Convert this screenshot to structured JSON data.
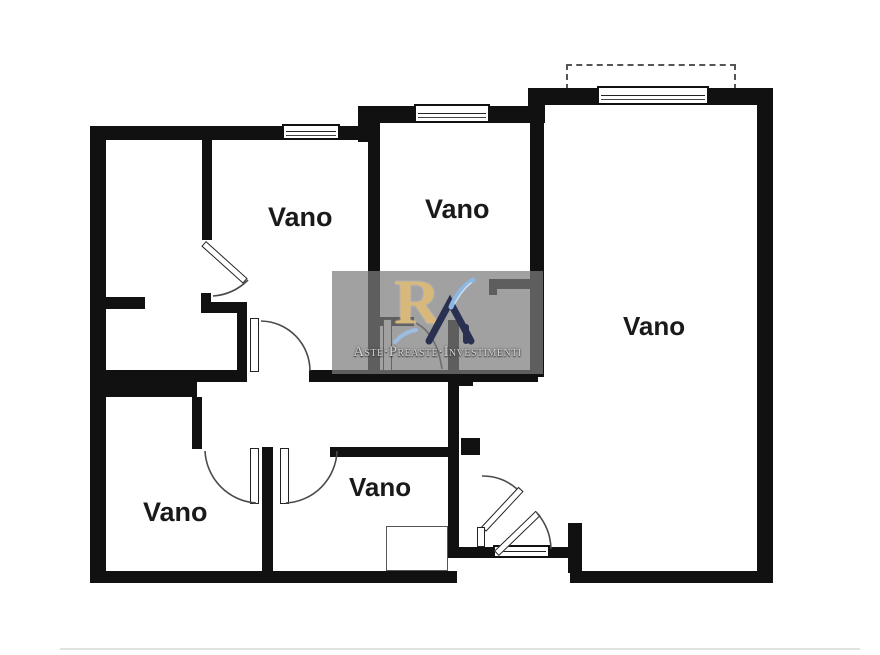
{
  "title": "Planimetria appartamento",
  "rooms": [
    {
      "id": "room-top-left",
      "label": "Vano"
    },
    {
      "id": "room-top-center",
      "label": "Vano"
    },
    {
      "id": "room-right-large",
      "label": "Vano"
    },
    {
      "id": "room-bottom-left",
      "label": "Vano"
    },
    {
      "id": "room-bottom-center",
      "label": "Vano"
    }
  ],
  "watermark": {
    "logo_letter": "R",
    "text": "Aste·Preaste·Investimenti"
  },
  "colors": {
    "wall": "#111111",
    "background": "#ffffff",
    "watermark_panel": "#7d7d7d",
    "logo_gold": "#d8b97b",
    "logo_navy": "#2a3050",
    "logo_blue": "#8fb6e0"
  }
}
